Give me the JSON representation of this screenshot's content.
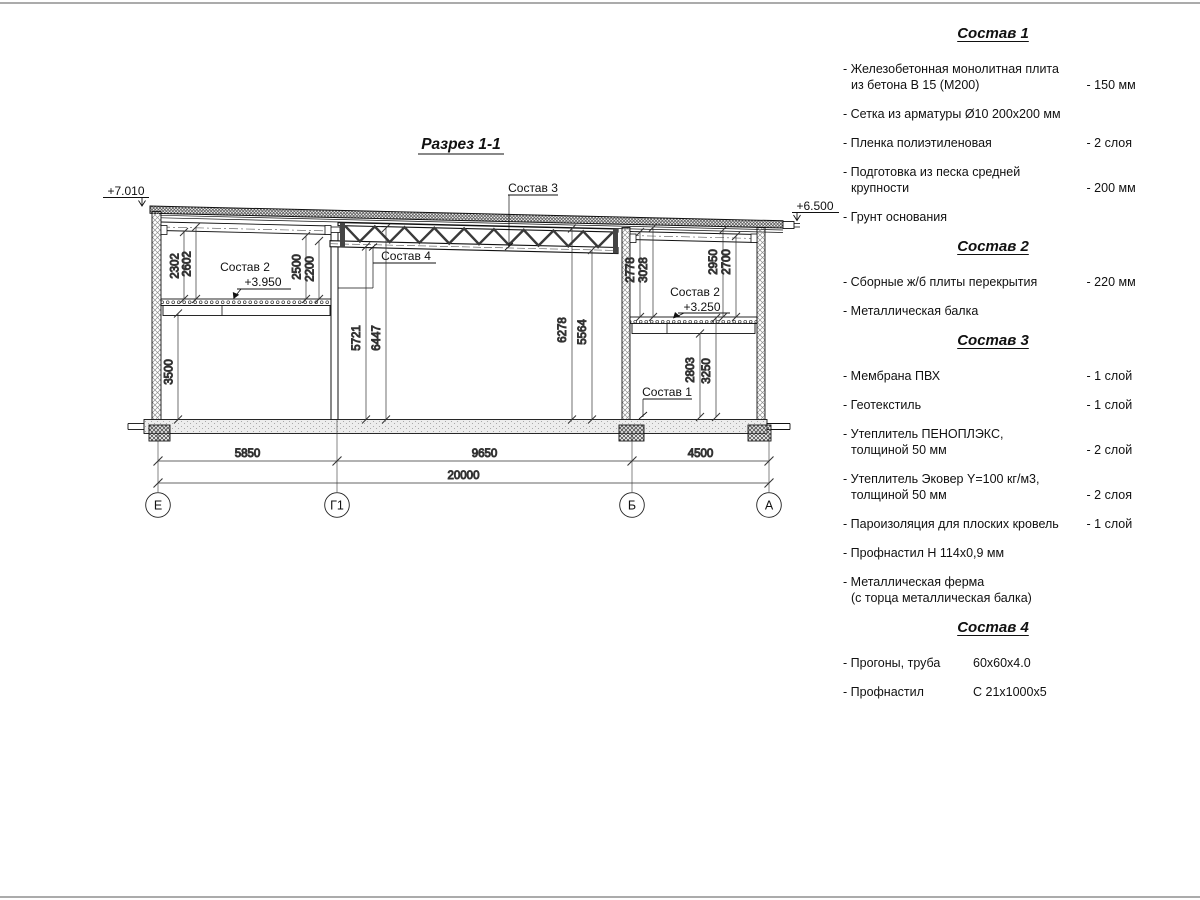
{
  "drawing": {
    "section_title": "Разрез 1-1",
    "elevation_left": "+7.010",
    "elevation_right": "+6.500",
    "level_left": "+3.950",
    "level_right": "+3.250",
    "callouts": {
      "c1": "Состав 1",
      "c2_left": "Состав 2",
      "c2_right": "Состав 2",
      "c3": "Состав 3",
      "c4": "Состав 4"
    },
    "dims": {
      "h3500": "3500",
      "h2302": "2302",
      "h2602": "2602",
      "h2500": "2500",
      "h2200": "2200",
      "h5721": "5721",
      "h6447": "6447",
      "h6278": "6278",
      "h5564": "5564",
      "h2778": "2778",
      "h3028": "3028",
      "h2950": "2950",
      "h2700": "2700",
      "h2803": "2803",
      "h3250": "3250"
    },
    "bottom_dims": {
      "bay1": "5850",
      "bay2": "9650",
      "bay3": "4500",
      "total": "20000"
    },
    "axes": {
      "a1": "Е",
      "a2": "Г1",
      "a3": "Б",
      "a4": "А"
    }
  },
  "legend": {
    "sections": [
      {
        "title": "Состав 1",
        "items": [
          {
            "name": "- Железобетонная монолитная плита\nиз бетона В 15 (М200)",
            "value": "- 150 мм"
          },
          {
            "name": "- Сетка из арматуры Ø10 200х200 мм",
            "value": ""
          },
          {
            "name": "- Пленка полиэтиленовая",
            "value": "-  2 слоя"
          },
          {
            "name": "- Подготовка из песка средней\nкрупности",
            "value": "- 200 мм"
          },
          {
            "name": "- Грунт основания",
            "value": ""
          }
        ]
      },
      {
        "title": "Состав 2",
        "items": [
          {
            "name": "- Сборные ж/б плиты перекрытия",
            "value": "- 220 мм"
          },
          {
            "name": "- Металлическая балка",
            "value": ""
          }
        ]
      },
      {
        "title": "Состав 3",
        "items": [
          {
            "name": "- Мембрана ПВХ",
            "value": "- 1 слой"
          },
          {
            "name": "- Геотекстиль",
            "value": "- 1 слой"
          },
          {
            "name": "- Утеплитель ПЕНОПЛЭКС,\nтолщиной 50 мм",
            "value": "- 2 слой"
          },
          {
            "name": "- Утеплитель Эковер Y=100 кг/м3,\nтолщиной 50 мм",
            "value": "- 2 слоя"
          },
          {
            "name": "- Пароизоляция для плоских кровель",
            "value": "- 1 слой"
          },
          {
            "name": "- Профнастил Н 114х0,9 мм",
            "value": ""
          },
          {
            "name": "- Металлическая ферма\n(с торца металлическая балка)",
            "value": ""
          }
        ]
      },
      {
        "title": "Состав 4",
        "items": [
          {
            "name": "- Прогоны, труба",
            "value": "60х60х4.0"
          },
          {
            "name": "- Профнастил",
            "value": "С 21х1000х5"
          }
        ]
      }
    ]
  }
}
